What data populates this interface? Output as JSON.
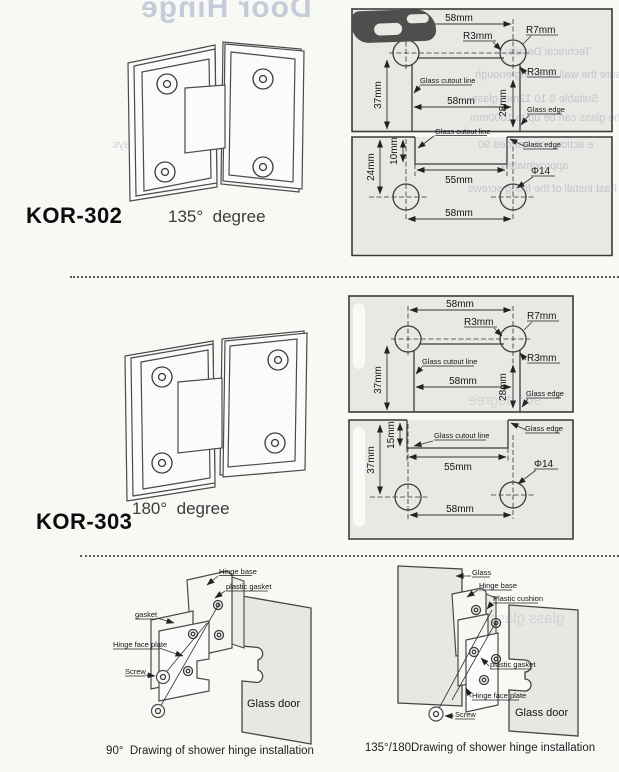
{
  "bleed": {
    "title": "Door Hinge",
    "left1": "s must be toughened.",
    "left2": "m in width.",
    "left3": "self-closing when the door stays",
    "tech_title": "Technical Details:",
    "tech1": "Ensure the wall is strong enough",
    "tech2": "Suitable 8 10 12mm glass",
    "tech3": "The glass can be up to 1000mm",
    "tech4": "e action non-handed 90",
    "tech5": "approximately",
    "tech6": "Fast install of the fixing screws",
    "mid_degree": "90° degree",
    "mid_glass": "glass    glass"
  },
  "products": [
    {
      "model": "KOR-302",
      "angle": "135°  degree",
      "dims": {
        "top_width": "58mm",
        "r3": "R3mm",
        "r7": "R7mm",
        "r3b": "R3mm",
        "left_h": "37mm",
        "mid_width": "58mm",
        "right_h": "28mm",
        "cutout": "Glass cutout line",
        "edge": "Glass edge",
        "cutout2": "Glass cutout line",
        "edge2": "Glass edge",
        "notch_h": "24mm",
        "notch_d": "10mm",
        "notch_w": "55mm",
        "hole": "Φ14",
        "span": "58mm"
      }
    },
    {
      "model": "KOR-303",
      "angle": "180°  degree",
      "dims": {
        "top_width": "58mm",
        "r3": "R3mm",
        "r7": "R7mm",
        "r3b": "R3mm",
        "left_h": "37mm",
        "mid_width": "58mm",
        "right_h": "28mm",
        "cutout": "Glass cutout line",
        "edge": "Glass edge",
        "cutout2": "Glass cutout line",
        "edge2": "Glass edge",
        "notch_h": "37mm",
        "notch_d": "15mm",
        "notch_w": "55mm",
        "hole": "Φ14",
        "span": "58mm"
      }
    }
  ],
  "installs": [
    {
      "caption": "90°  Drawing of shower hinge installation",
      "door": "Glass door",
      "labels": {
        "hinge_base": "Hinge base",
        "plastic_gasket": "plastic gasket",
        "gasket": "gasket",
        "face_plate": "Hinge face plate",
        "screw": "Screw"
      }
    },
    {
      "caption": "135°/180Drawing of shower hinge installation",
      "door": "Glass door",
      "labels": {
        "glass": "Glass",
        "hinge_base": "Hinge base",
        "cushion": "Plastic cushion",
        "plastic_gasket": "plastic gasket",
        "face_plate": "Hinge face plate",
        "screw": "Screw"
      }
    }
  ]
}
